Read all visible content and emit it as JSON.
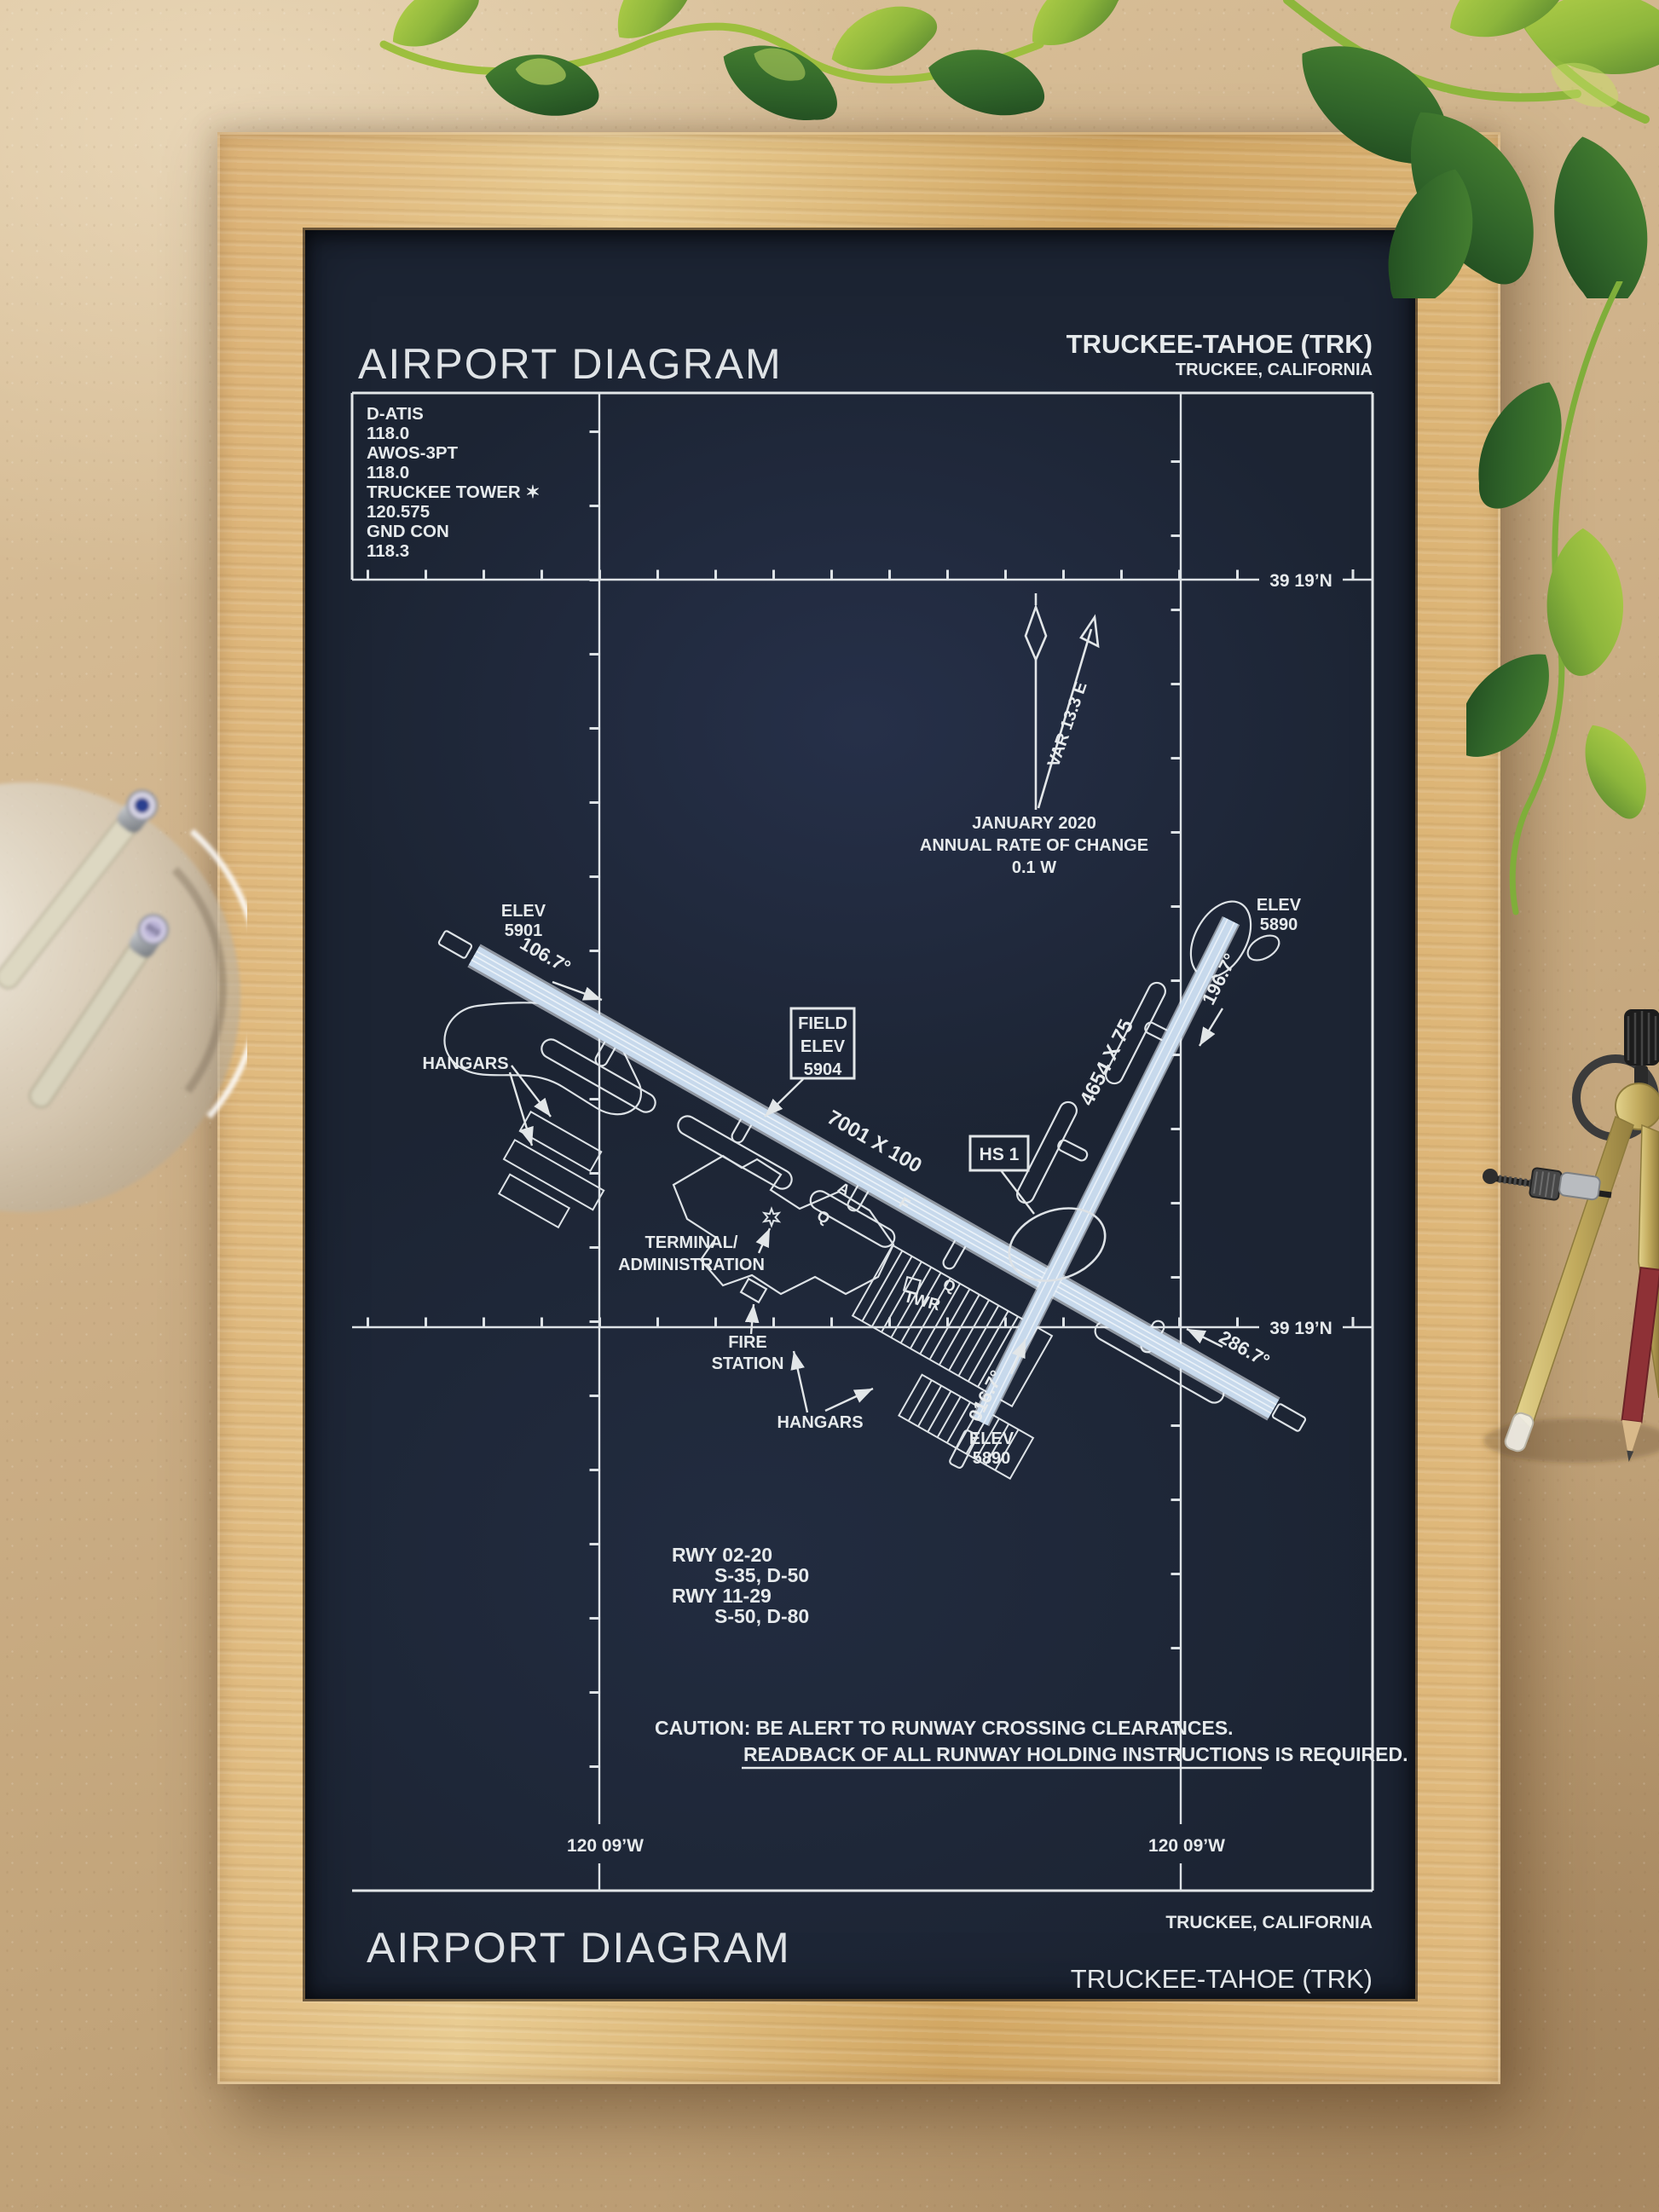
{
  "header": {
    "title": "AIRPORT DIAGRAM",
    "airport": "TRUCKEE-TAHOE (TRK)",
    "city": "TRUCKEE, CALIFORNIA"
  },
  "comm": {
    "rows": [
      "D-ATIS",
      "118.0",
      "AWOS-3PT",
      "118.0",
      "TRUCKEE TOWER ✶",
      "120.575",
      "GND CON",
      "118.3"
    ]
  },
  "geo": {
    "lat_top": "39 19’N",
    "lat_bottom": "39 19’N",
    "lon_left": "120 09’W",
    "lon_right": "120 09’W"
  },
  "north": {
    "var": "VAR 13.3  E",
    "month": "JANUARY 2020",
    "rate": "ANNUAL RATE OF CHANGE",
    "value": "0.1  W"
  },
  "field_elev": {
    "l1": "FIELD",
    "l2": "ELEV",
    "l3": "5904"
  },
  "hot_spot": {
    "label": "HS 1"
  },
  "runways": {
    "rwy_11_29": {
      "dimensions": "7001 X 100",
      "heading_11": "106.7°",
      "heading_29": "286.7°"
    },
    "rwy_02_20": {
      "dimensions": "4654 X 75",
      "heading_02": "016.7°",
      "heading_20": "196.7°"
    }
  },
  "elevations": {
    "rwy11": {
      "l1": "ELEV",
      "l2": "5901"
    },
    "rwy20": {
      "l1": "ELEV",
      "l2": "5890"
    },
    "rwy02": {
      "l1": "ELEV",
      "l2": "5890"
    }
  },
  "buildings": {
    "hangars_west": "HANGARS",
    "hangars_south": "HANGARS",
    "terminal_l1": "TERMINAL/",
    "terminal_l2": "ADMINISTRATION",
    "fire_l1": "FIRE",
    "fire_l2": "STATION",
    "tower": "TWR"
  },
  "taxiways": {
    "a": "A",
    "f": "F",
    "q1": "Q",
    "q2": "Q"
  },
  "runway_data": {
    "r1": "RWY 02-20",
    "r1_strength": "S-35, D-50",
    "r2": "RWY 11-29",
    "r2_strength": "S-50, D-80"
  },
  "caution": {
    "line1": "CAUTION: BE ALERT TO RUNWAY CROSSING CLEARANCES.",
    "line2": "READBACK OF ALL RUNWAY HOLDING INSTRUCTIONS IS REQUIRED."
  },
  "footer": {
    "city": "TRUCKEE, CALIFORNIA",
    "airport": "TRUCKEE-TAHOE (TRK)",
    "title": "AIRPORT DIAGRAM"
  },
  "props": {
    "pen_cap_label": "005"
  },
  "colors": {
    "poster_bg": "#1c2433",
    "line": "#e2e6e8",
    "runway_fill": "#c7d9ec",
    "frame_wood": "#dcb276",
    "backdrop": "#c9ac82",
    "leaf_green": "#3c6e2b",
    "leaf_light": "#a9c93f",
    "brass": "#c2ab5e"
  }
}
